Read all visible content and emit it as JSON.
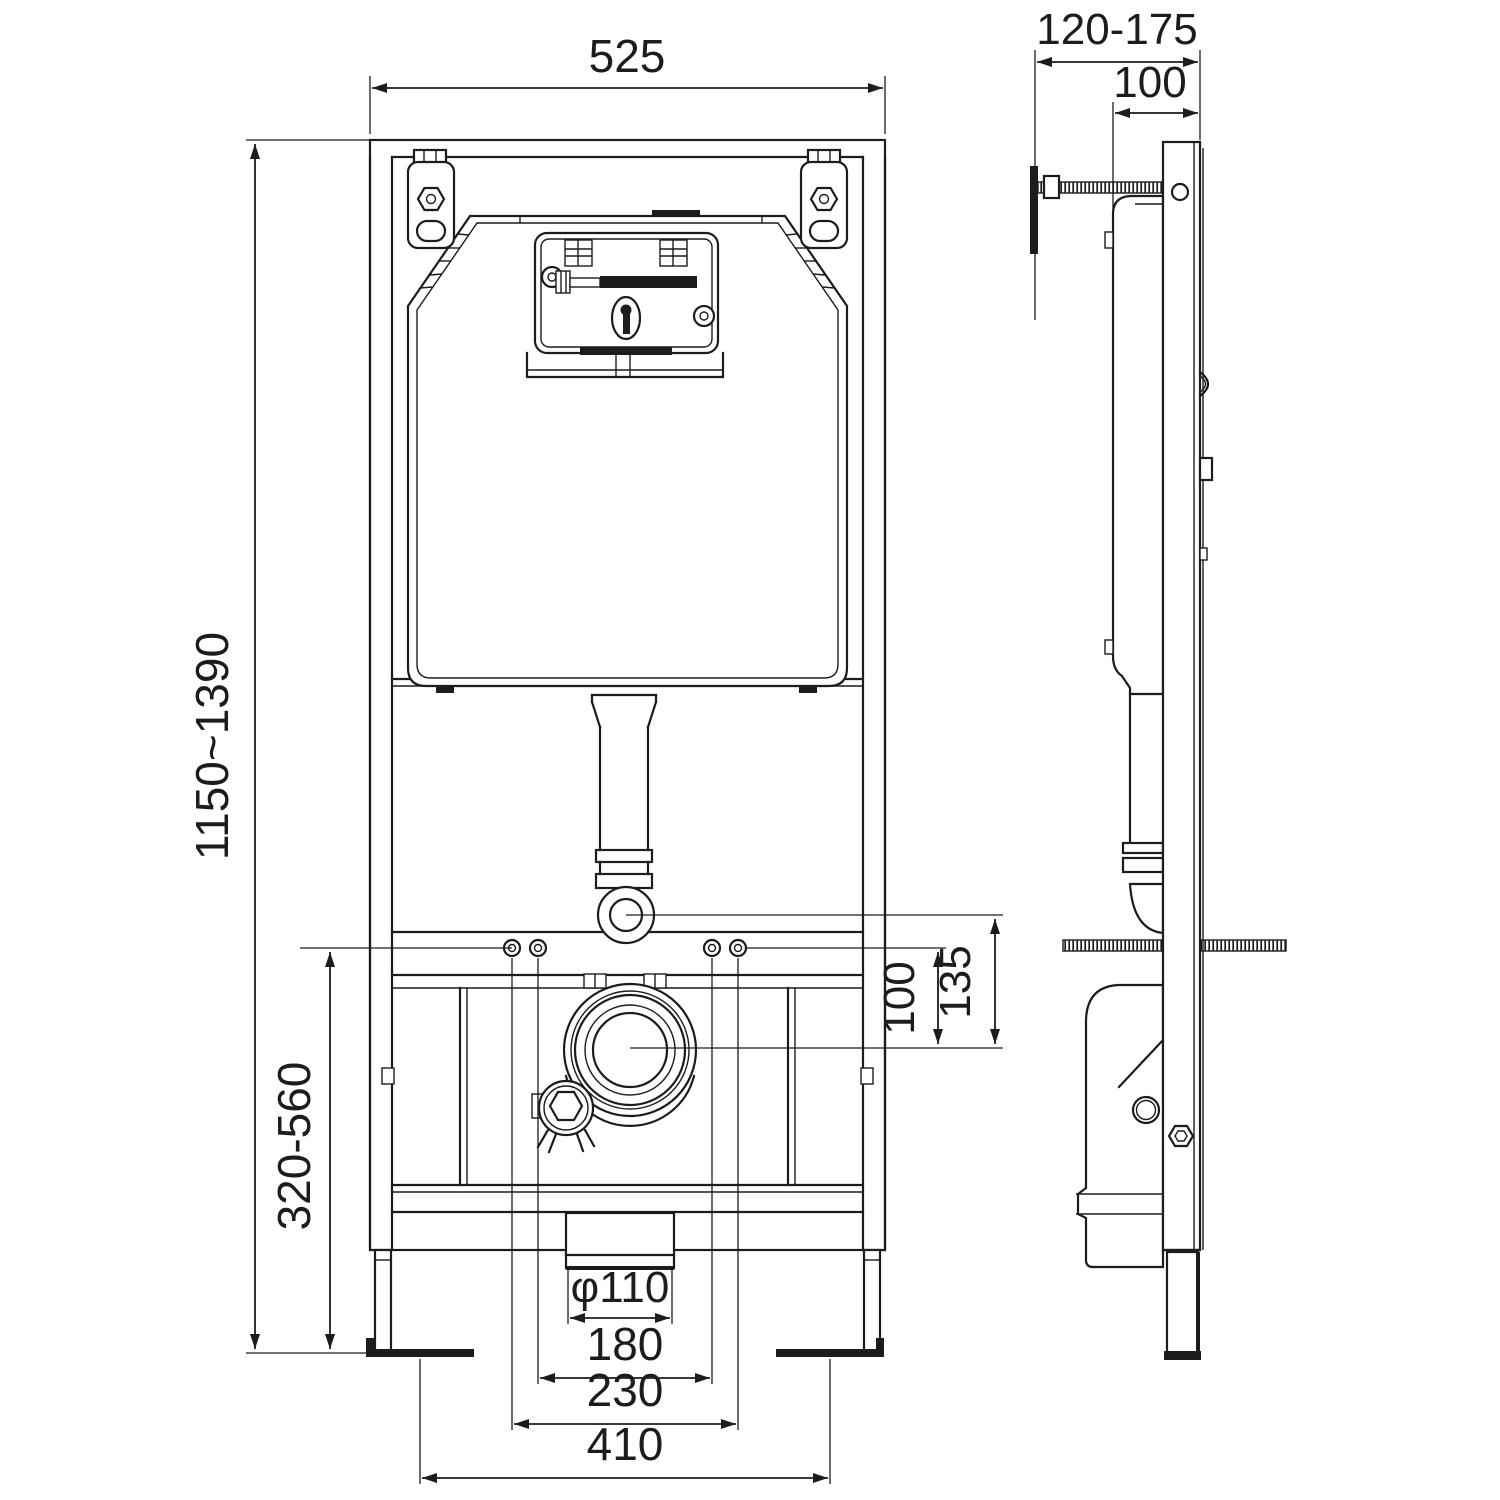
{
  "page": {
    "background": "#ffffff",
    "line_color": "#1c1c1c",
    "kind": "technical-installation-drawing",
    "subject": "concealed-cistern-wc-mounting-frame"
  },
  "views": {
    "front": "front-view",
    "side": "side-view"
  },
  "dims": {
    "front_width": "525",
    "front_height_range": "1150~1390",
    "outlet_height_range": "320-560",
    "fixing_to_outlet": "100",
    "flush_bend_to_outlet": "135",
    "outlet_diameter": "φ110",
    "fixing_spacing_inner": "180",
    "fixing_spacing_outer": "230",
    "feet_bracket_spacing": "410",
    "side_depth_range": "120-175",
    "side_frame_depth": "100"
  }
}
